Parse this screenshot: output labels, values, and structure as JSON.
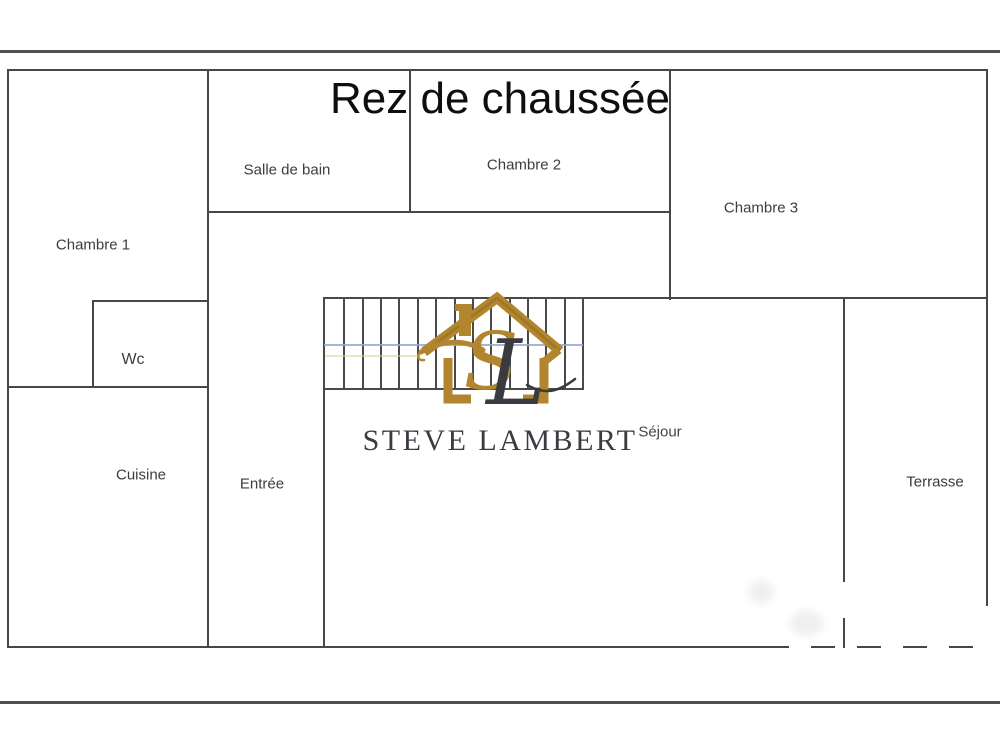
{
  "page": {
    "title": "Rez de chaussée"
  },
  "watermark": {
    "brand": "STEVE LAMBERT",
    "monogram": {
      "s": "S",
      "l": "L"
    },
    "house_icon": "gold-house-outline"
  },
  "rooms": [
    {
      "id": "chambre-1",
      "label": "Chambre 1"
    },
    {
      "id": "salle-de-bain",
      "label": "Salle de bain"
    },
    {
      "id": "chambre-2",
      "label": "Chambre 2"
    },
    {
      "id": "chambre-3",
      "label": "Chambre 3"
    },
    {
      "id": "wc",
      "label": "Wc"
    },
    {
      "id": "cuisine",
      "label": "Cuisine"
    },
    {
      "id": "entree",
      "label": "Entrée"
    },
    {
      "id": "sejour",
      "label": "Séjour"
    },
    {
      "id": "terrasse",
      "label": "Terrasse"
    }
  ],
  "stairs": {
    "tread_count": 14,
    "section_line_color": "#92a8d5"
  },
  "colors": {
    "wall": "#474747",
    "gold": "#b2862e",
    "gold_dark": "#8a651f",
    "brand_text": "#3b3b41",
    "blue_line": "#92a8d5",
    "yellow_line": "#d9d093",
    "title_text": "#0e0e0e"
  }
}
